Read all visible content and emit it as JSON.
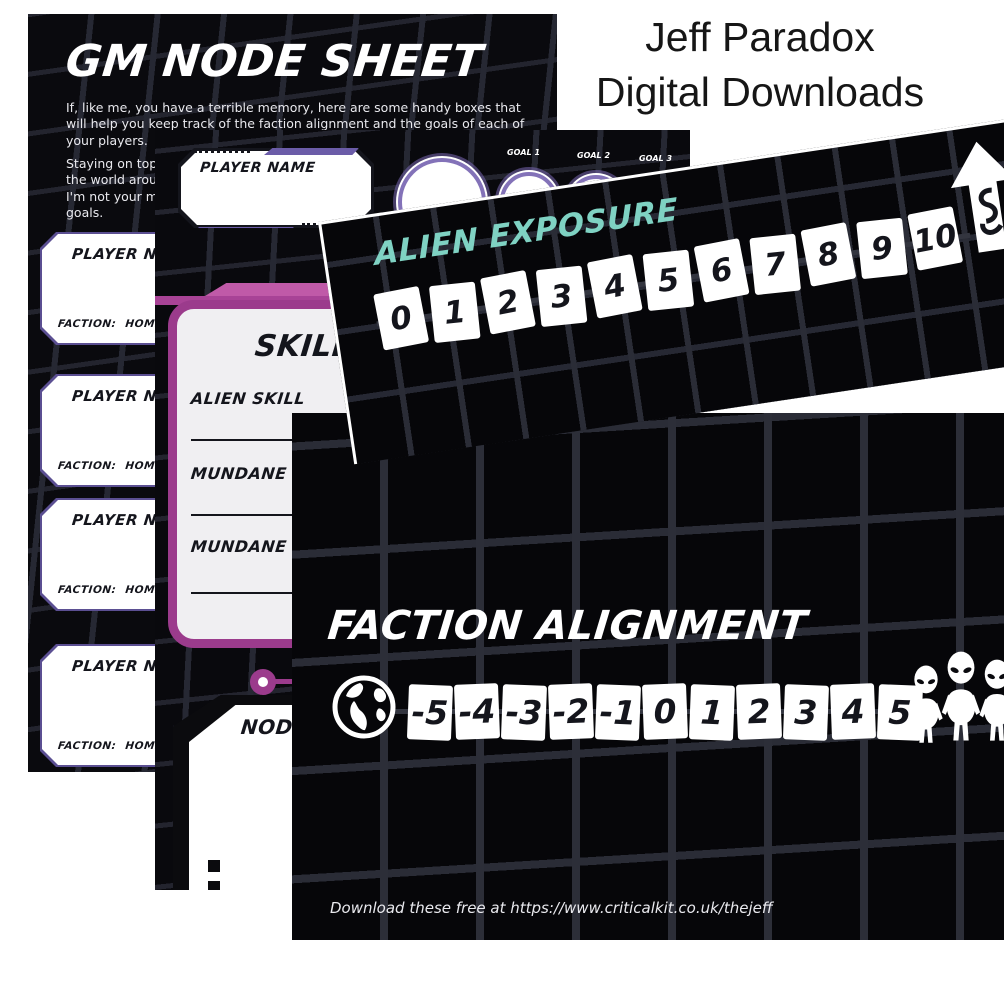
{
  "brand": {
    "line1": "Jeff Paradox",
    "line2": "Digital Downloads"
  },
  "gm_sheet": {
    "title": "GM NODE SHEET",
    "intro": "If, like me, you have a terrible memory, here are some handy boxes that\nwill help you keep track of the faction alignment and the goals of each of\nyour players.",
    "side_note": "Staying on top\nthe world arou\nI'm not your m\ngoals.",
    "player_box_label": "PLAYER NAME",
    "faction_label": "FACTION:",
    "faction_value": "HOMEW"
  },
  "character_sheet": {
    "player_name_label": "PLAYER NAME",
    "goal_labels": [
      "GOAL 1",
      "GOAL 2",
      "GOAL 3"
    ],
    "skills": {
      "title": "SKILLS",
      "items": [
        "ALIEN SKILL",
        "MUNDANE SKILL",
        "MUNDANE SKILL"
      ]
    },
    "node_box_label": "NODE BRIEF"
  },
  "alien_exposure": {
    "title": "ALIEN EXPOSURE",
    "values": [
      "0",
      "1",
      "2",
      "3",
      "4",
      "5",
      "6",
      "7",
      "8",
      "9",
      "10"
    ],
    "accent_color": "#7fd2c3"
  },
  "faction_alignment": {
    "title": "FACTION ALIGNMENT",
    "values": [
      "-5",
      "-4",
      "-3",
      "-2",
      "-1",
      "0",
      "1",
      "2",
      "3",
      "4",
      "5"
    ],
    "footer": "Download these free at https://www.criticalkit.co.uk/thejeff"
  },
  "colors": {
    "sheet_black": "#0a0a0e",
    "grid_line": "#2c2e38",
    "purple_accent": "#6b5ca8",
    "magenta_accent": "#9b3b8c",
    "teal_accent": "#7fd2c3"
  }
}
